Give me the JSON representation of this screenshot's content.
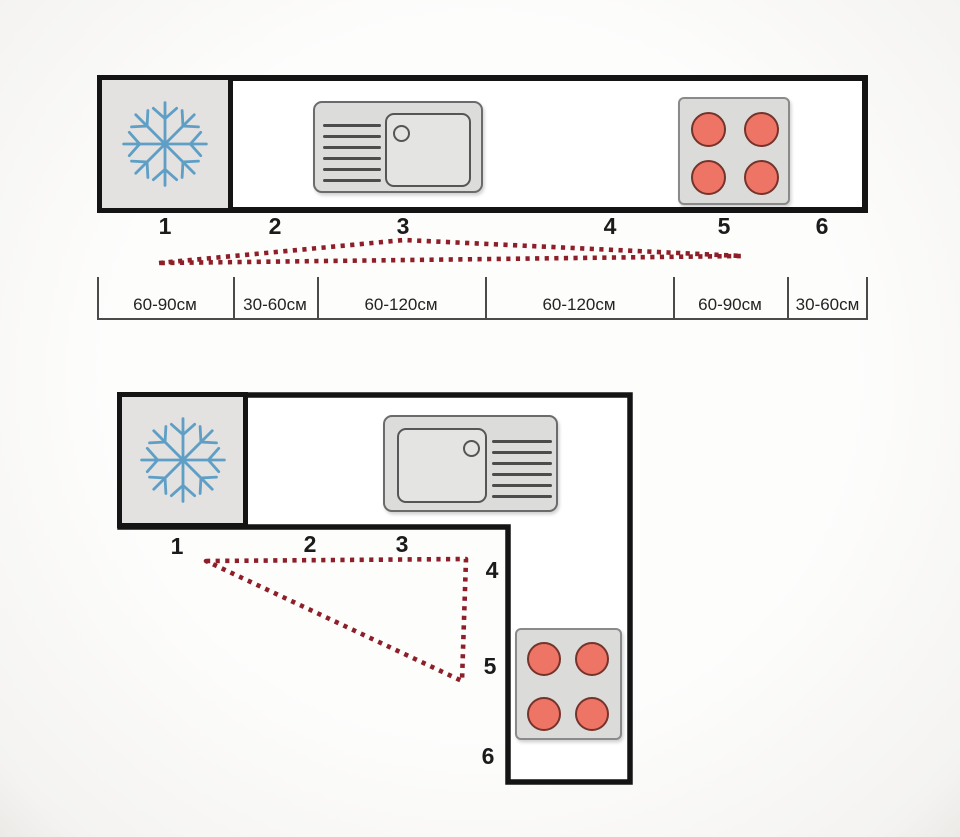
{
  "positions": [
    "1",
    "2",
    "3",
    "4",
    "5",
    "6"
  ],
  "linear_kitchen": {
    "measurements": [
      "60-90см",
      "30-60см",
      "60-120см",
      "60-120см",
      "60-90см",
      "30-60см"
    ]
  },
  "icons": {
    "refrigerator": "snowflake-icon",
    "sink": "sink-with-drainboard-icon",
    "cooktop": "four-burner-hob-icon"
  },
  "colors": {
    "outline": "#141414",
    "work_triangle_dotted": "#8e1f29",
    "snowflake_blue": "#5f9fc6",
    "burner_red": "#ee7465",
    "appliance_gray": "#dcdcdb"
  }
}
